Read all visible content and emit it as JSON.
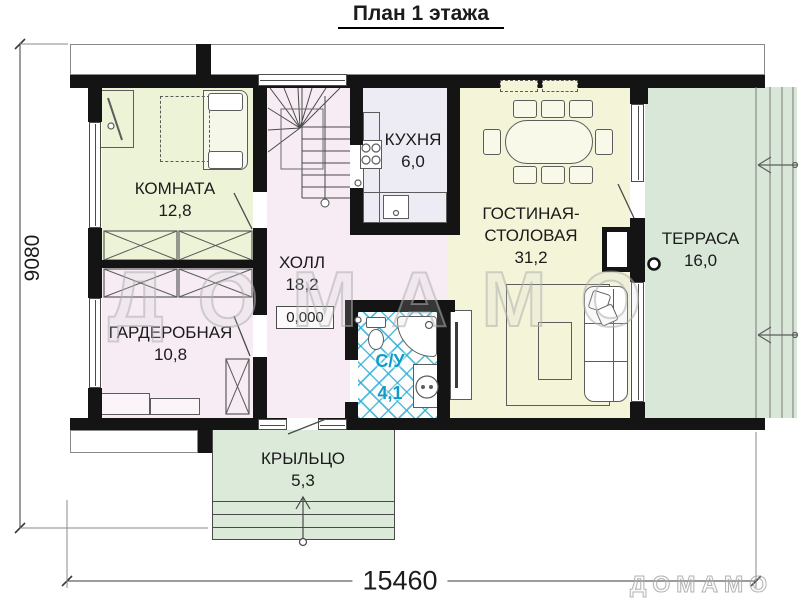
{
  "title": "План 1 этажа",
  "watermark": {
    "large": "ДОМАМО",
    "small": "ДОМАМО"
  },
  "dimensions": {
    "vertical": "9080",
    "horizontal": "15460"
  },
  "level_mark": "0,000",
  "rooms": {
    "komnata": {
      "name": "КОМНАТА",
      "area": "12,8"
    },
    "garderobnaya": {
      "name": "ГАРДЕРОБНАЯ",
      "area": "10,8"
    },
    "holl": {
      "name": "ХОЛЛ",
      "area": "18,2"
    },
    "kuhnya": {
      "name": "КУХНЯ",
      "area": "6,0"
    },
    "su": {
      "name": "С/У",
      "area": "4,1"
    },
    "gostinaya": {
      "name": "ГОСТИНАЯ-СТОЛОВАЯ",
      "area": "31,2"
    },
    "terrasa": {
      "name": "ТЕРРАСА",
      "area": "16,0"
    },
    "kryltso": {
      "name": "КРЫЛЬЦО",
      "area": "5,3"
    }
  },
  "colors": {
    "wall": "#141414",
    "room_komnata": "#edf3d7",
    "room_pink": "#f7ecf4",
    "room_kitchen": "#edebf3",
    "room_living": "#f4f4d8",
    "terrace": "#d8e7d7",
    "porch": "#dcead9",
    "tile_blue": "#2badd4",
    "su_text": "#0f9cc9"
  }
}
